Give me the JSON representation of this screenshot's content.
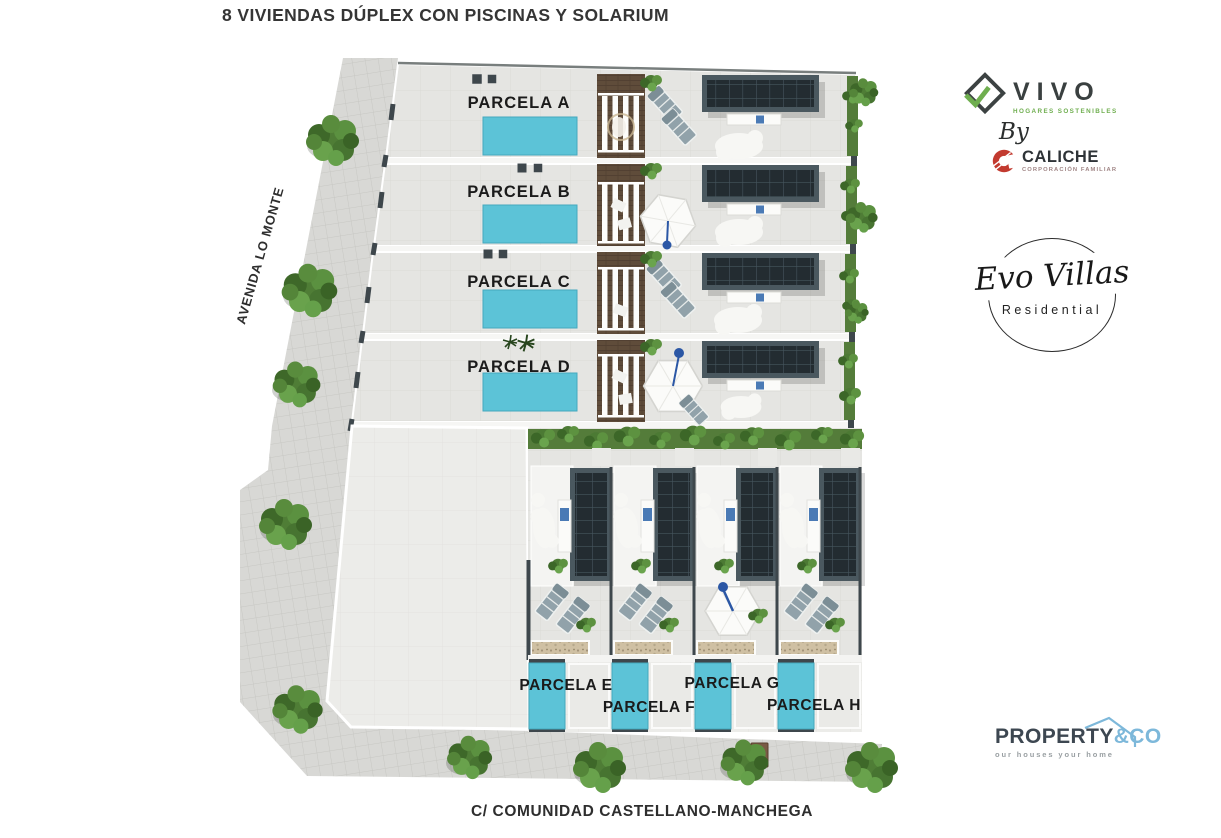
{
  "title": "8 VIVIENDAS DÚPLEX CON PISCINAS Y SOLARIUM",
  "streets": {
    "left": "AVENIDA LO MONTE",
    "bottom": "C/ COMUNIDAD CASTELLANO-MANCHEGA"
  },
  "parcels": [
    {
      "id": "A",
      "label": "PARCELA A"
    },
    {
      "id": "B",
      "label": "PARCELA B"
    },
    {
      "id": "C",
      "label": "PARCELA C"
    },
    {
      "id": "D",
      "label": "PARCELA D"
    },
    {
      "id": "E",
      "label": "PARCELA E"
    },
    {
      "id": "F",
      "label": "PARCELA F"
    },
    {
      "id": "G",
      "label": "PARCELA G"
    },
    {
      "id": "H",
      "label": "PARCELA H"
    }
  ],
  "logos": {
    "vivo": {
      "name": "VIVO",
      "tagline": "HOGARES SOSTENIBLES",
      "by": "By"
    },
    "caliche": {
      "name": "CALICHE",
      "tagline": "CORPORACIÓN FAMILIAR"
    },
    "evo_villas": {
      "name": "Evo Villas",
      "subtitle": "Residential"
    },
    "property_co": {
      "name": "PROPERTY",
      "suffix": "&CO",
      "tagline": "our houses your home"
    }
  },
  "colors": {
    "pool": "#5cc3d7",
    "roof_frame": "#4a585f",
    "solar_panel": "#232c31",
    "hedge": "#547c3a",
    "pavement": "#d8d8d5",
    "vivo_green": "#6fae4f",
    "caliche_red": "#c23a2f",
    "property_blue": "#7db8da"
  }
}
